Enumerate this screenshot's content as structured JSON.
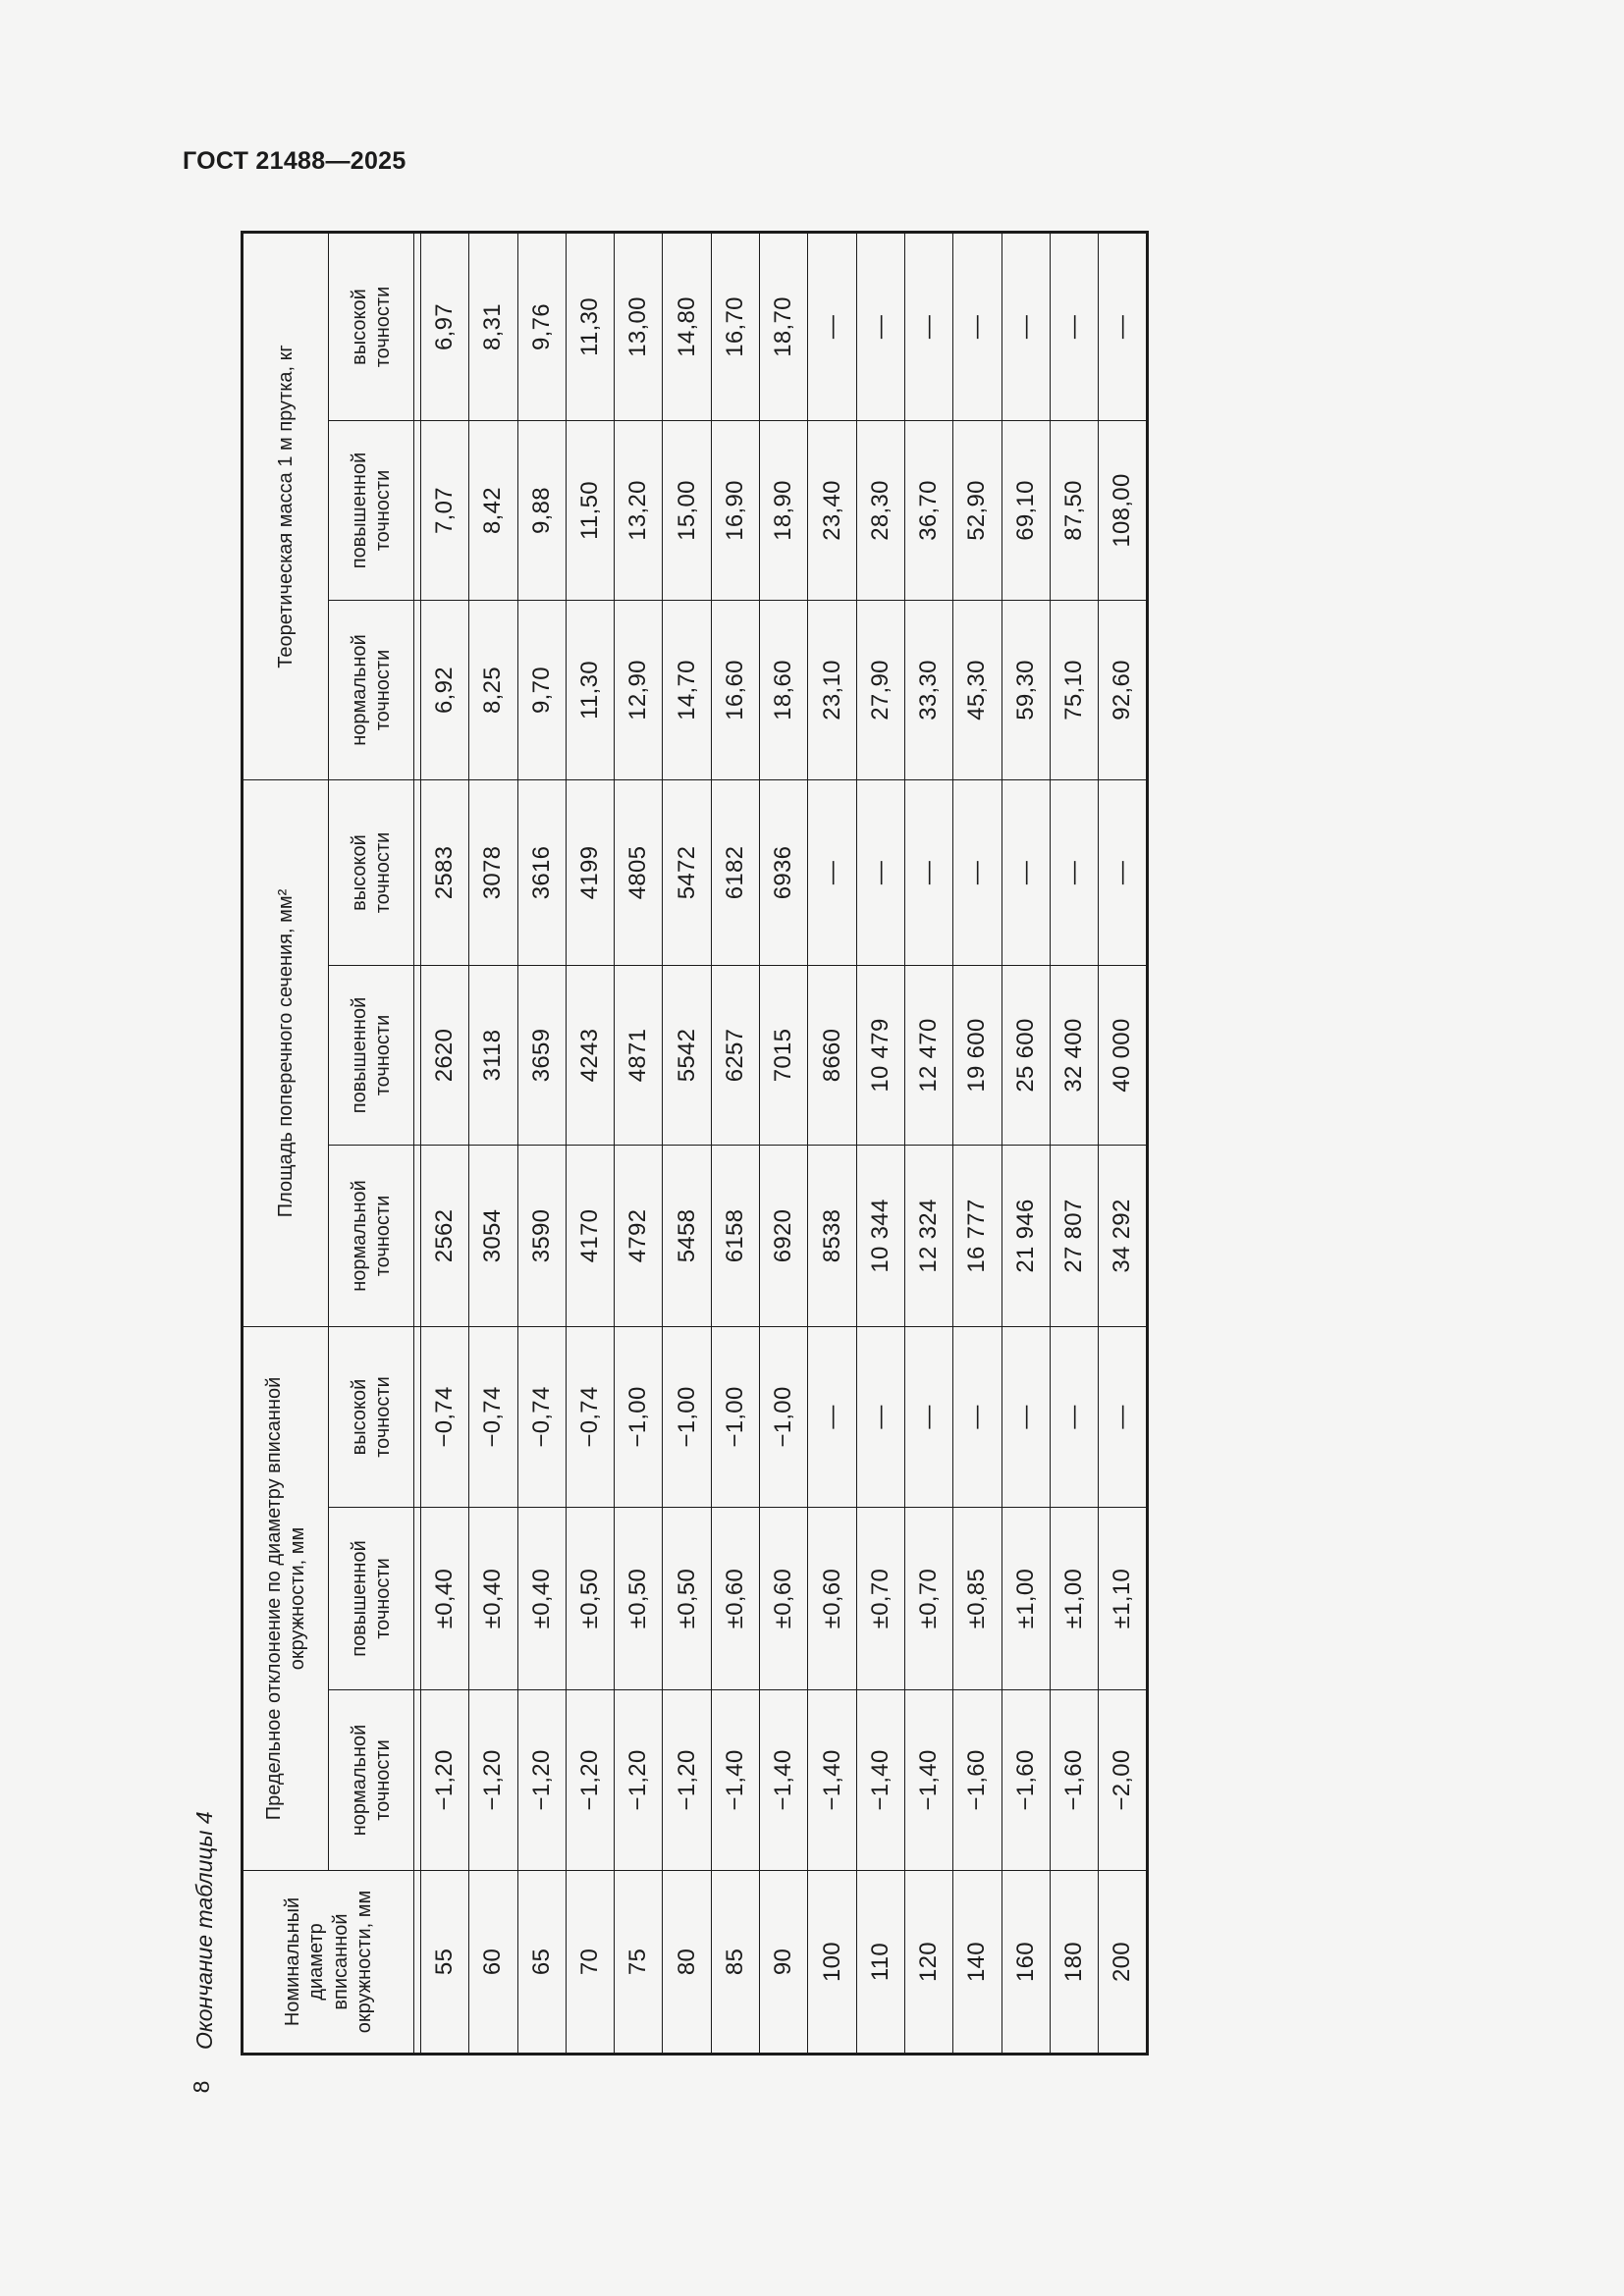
{
  "document": {
    "standard_code": "ГОСТ 21488—2025",
    "page_number": "8",
    "table_caption": "Окончание таблицы 4"
  },
  "table": {
    "diameter_header": "Номинальный\nдиаметр\nвписанной\nокружности, мм",
    "groups": {
      "deviation": "Предельное отклонение по диаметру вписанной\nокружности, мм",
      "area": "Площадь поперечного сечения, мм²",
      "mass": "Теоретическая масса 1 м прутка, кг"
    },
    "precision_subheaders": [
      "нормальной\nточности",
      "повышенной\nточности",
      "высокой\nточности"
    ],
    "rows": [
      {
        "diameter": "55",
        "deviation": [
          "−1,20",
          "±0,40",
          "−0,74"
        ],
        "area": [
          "2562",
          "2620",
          "2583"
        ],
        "mass": [
          "6,92",
          "7,07",
          "6,97"
        ]
      },
      {
        "diameter": "60",
        "deviation": [
          "−1,20",
          "±0,40",
          "−0,74"
        ],
        "area": [
          "3054",
          "3118",
          "3078"
        ],
        "mass": [
          "8,25",
          "8,42",
          "8,31"
        ]
      },
      {
        "diameter": "65",
        "deviation": [
          "−1,20",
          "±0,40",
          "−0,74"
        ],
        "area": [
          "3590",
          "3659",
          "3616"
        ],
        "mass": [
          "9,70",
          "9,88",
          "9,76"
        ]
      },
      {
        "diameter": "70",
        "deviation": [
          "−1,20",
          "±0,50",
          "−0,74"
        ],
        "area": [
          "4170",
          "4243",
          "4199"
        ],
        "mass": [
          "11,30",
          "11,50",
          "11,30"
        ]
      },
      {
        "diameter": "75",
        "deviation": [
          "−1,20",
          "±0,50",
          "−1,00"
        ],
        "area": [
          "4792",
          "4871",
          "4805"
        ],
        "mass": [
          "12,90",
          "13,20",
          "13,00"
        ]
      },
      {
        "diameter": "80",
        "deviation": [
          "−1,20",
          "±0,50",
          "−1,00"
        ],
        "area": [
          "5458",
          "5542",
          "5472"
        ],
        "mass": [
          "14,70",
          "15,00",
          "14,80"
        ]
      },
      {
        "diameter": "85",
        "deviation": [
          "−1,40",
          "±0,60",
          "−1,00"
        ],
        "area": [
          "6158",
          "6257",
          "6182"
        ],
        "mass": [
          "16,60",
          "16,90",
          "16,70"
        ]
      },
      {
        "diameter": "90",
        "deviation": [
          "−1,40",
          "±0,60",
          "−1,00"
        ],
        "area": [
          "6920",
          "7015",
          "6936"
        ],
        "mass": [
          "18,60",
          "18,90",
          "18,70"
        ]
      },
      {
        "diameter": "100",
        "deviation": [
          "−1,40",
          "±0,60",
          "—"
        ],
        "area": [
          "8538",
          "8660",
          "—"
        ],
        "mass": [
          "23,10",
          "23,40",
          "—"
        ]
      },
      {
        "diameter": "110",
        "deviation": [
          "−1,40",
          "±0,70",
          "—"
        ],
        "area": [
          "10 344",
          "10 479",
          "—"
        ],
        "mass": [
          "27,90",
          "28,30",
          "—"
        ]
      },
      {
        "diameter": "120",
        "deviation": [
          "−1,40",
          "±0,70",
          "—"
        ],
        "area": [
          "12 324",
          "12 470",
          "—"
        ],
        "mass": [
          "33,30",
          "36,70",
          "—"
        ]
      },
      {
        "diameter": "140",
        "deviation": [
          "−1,60",
          "±0,85",
          "—"
        ],
        "area": [
          "16 777",
          "19 600",
          "—"
        ],
        "mass": [
          "45,30",
          "52,90",
          "—"
        ]
      },
      {
        "diameter": "160",
        "deviation": [
          "−1,60",
          "±1,00",
          "—"
        ],
        "area": [
          "21 946",
          "25 600",
          "—"
        ],
        "mass": [
          "59,30",
          "69,10",
          "—"
        ]
      },
      {
        "diameter": "180",
        "deviation": [
          "−1,60",
          "±1,00",
          "—"
        ],
        "area": [
          "27 807",
          "32 400",
          "—"
        ],
        "mass": [
          "75,10",
          "87,50",
          "—"
        ]
      },
      {
        "diameter": "200",
        "deviation": [
          "−2,00",
          "±1,10",
          "—"
        ],
        "area": [
          "34 292",
          "40 000",
          "—"
        ],
        "mass": [
          "92,60",
          "108,00",
          "—"
        ]
      }
    ]
  }
}
